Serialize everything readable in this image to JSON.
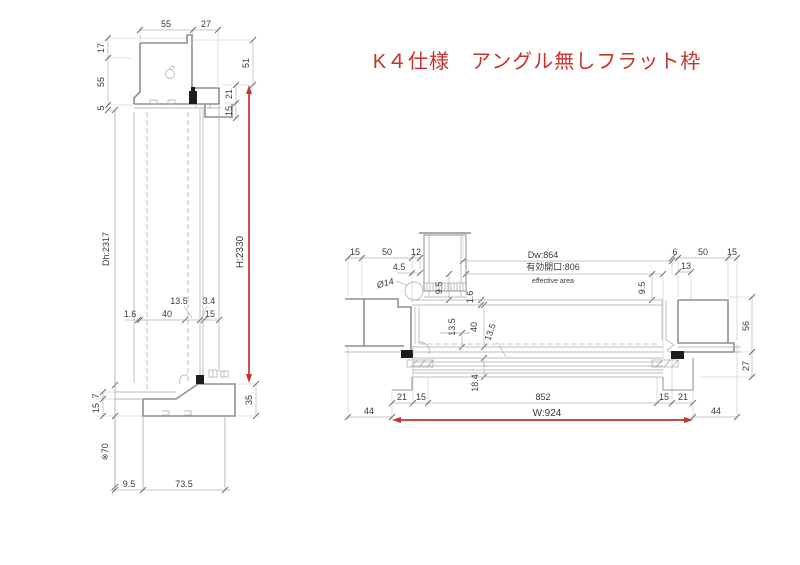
{
  "title": {
    "text": "K４仕様　アングル無しフラット枠"
  },
  "colors": {
    "accent_red": "#c5332d",
    "line_gray": "#8f8f8f",
    "text": "#3a3a3a"
  },
  "left_view": {
    "top": {
      "d55": "55",
      "d27": "27"
    },
    "left_chain": {
      "d17": "17",
      "d55": "55",
      "d5": "5"
    },
    "right_chain": {
      "d51": "51",
      "d21": "21",
      "d15": "15"
    },
    "height": {
      "dh": "Dh:2317",
      "h": "H:2330"
    },
    "mid": {
      "d135": "13.5",
      "d34": "3.4",
      "d16": "1.6",
      "d40": "40",
      "d15": "15"
    },
    "bottom": {
      "d7": "7",
      "d15": "15",
      "ref70": "※70",
      "d35": "35",
      "d95": "9.5",
      "d735": "73.5"
    }
  },
  "right_view": {
    "top_left": {
      "d15": "15",
      "d50": "50",
      "d12": "12",
      "d45": "4.5",
      "dia14": "Ø14",
      "d95": "9.5"
    },
    "top_center": {
      "dw": "Dw:864",
      "eff": "有効開口:806",
      "eff_en": "effective area"
    },
    "top_right": {
      "d6": "6",
      "d50": "50",
      "d15": "15",
      "d13": "13",
      "d95": "9.5",
      "d56": "56",
      "d27": "27"
    },
    "mid": {
      "d16": "1.6",
      "d135a": "13.5",
      "d40": "40",
      "d135b": "13.5",
      "d184": "18.4"
    },
    "bottom": {
      "d44l": "44",
      "d21l": "21",
      "d15l": "15",
      "d852": "852",
      "w": "W:924",
      "d15r": "15",
      "d21r": "21",
      "d44r": "44"
    }
  }
}
